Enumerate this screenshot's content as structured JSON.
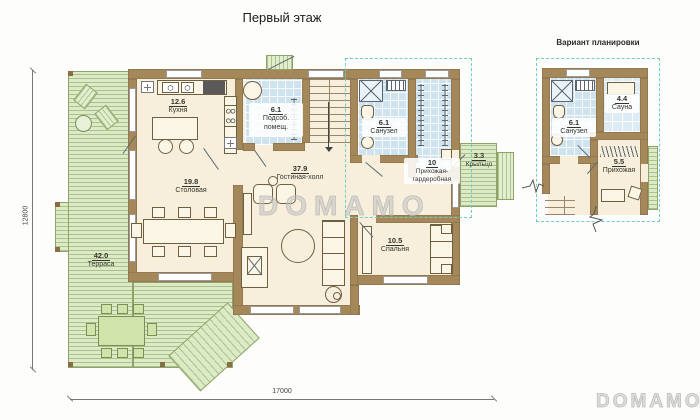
{
  "titles": {
    "main": "Первый этаж",
    "variant": "Вариант планировки"
  },
  "dimensions": {
    "horizontal": "17000",
    "vertical": "12800"
  },
  "rooms": {
    "kitchen": {
      "area": "12.6",
      "name": "Кухня"
    },
    "utility": {
      "area": "6.1",
      "name": "Подсоб. помещ."
    },
    "dining": {
      "area": "19.8",
      "name": "Столовая"
    },
    "living": {
      "area": "37.9",
      "name": "Гостиная-холл"
    },
    "bathroom": {
      "area": "6.1",
      "name": "Санузел"
    },
    "wardrobe": {
      "area": "10",
      "name": "Прихожая-гардеробная"
    },
    "porch": {
      "area": "3.3",
      "name": "Крыльцо"
    },
    "bedroom": {
      "area": "10.5",
      "name": "Спальня"
    },
    "terrace": {
      "area": "42.0",
      "name": "Терраса"
    }
  },
  "variant_rooms": {
    "bathroom": {
      "area": "6.1",
      "name": "Санузел"
    },
    "sauna": {
      "area": "4.4",
      "name": "Сауна"
    },
    "hallway": {
      "area": "5.5",
      "name": "Прихожая"
    }
  },
  "watermarks": {
    "center": "DOMAMO",
    "corner": "DOMAMO"
  },
  "colors": {
    "wall": "#a5885a",
    "floor": "#f7efdb",
    "tile": "#cfe3ef",
    "deck": "#dcebc6",
    "highlight": "#6fcdc2"
  }
}
